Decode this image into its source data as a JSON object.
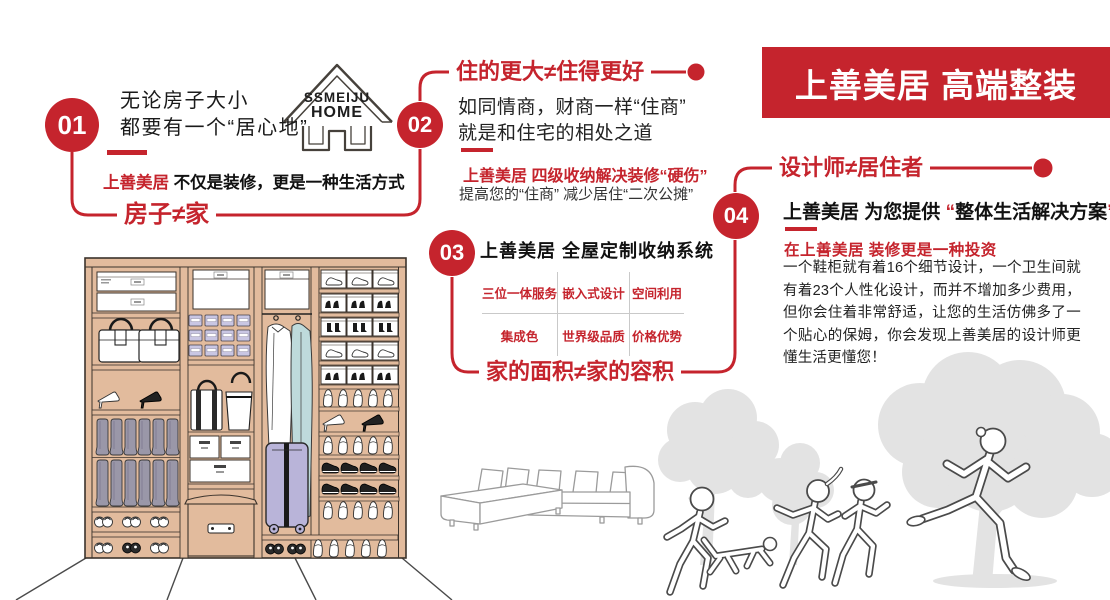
{
  "banner": {
    "title": "上善美居 高端整装"
  },
  "logo": {
    "line1": "SSMEIJU",
    "line2": "HOME"
  },
  "sections": {
    "s1": {
      "num": "01",
      "heading_line1": "无论房子大小",
      "heading_line2": "都要有一个“居心地”",
      "brand": "上善美居",
      "slogan": "不仅是装修，更是一种生活方式",
      "keyword": "房子≠家"
    },
    "s2": {
      "num": "02",
      "headline": "住的更大≠住得更好",
      "body_line1": "如同情商，财商一样“住商”",
      "body_line2": "就是和住宅的相处之道",
      "red_line": "上善美居 四级收纳解决装修“硬伤”",
      "sub_line": "提高您的“住商” 减少居住“二次公摊”"
    },
    "s3": {
      "num": "03",
      "title": "上善美居 全屋定制收纳系统",
      "cells": [
        "三位一体服务",
        "嵌入式设计",
        "空间利用",
        "集成色",
        "世界级品质",
        "价格优势"
      ],
      "keyword": "家的面积≠家的容积"
    },
    "s4": {
      "num": "04",
      "headline": "设计师≠居住者",
      "bold_prefix": "上善美居 为您提供 ",
      "quote_open": "“",
      "quote_text": "整体生活解决方案",
      "quote_close": "”",
      "red_line": "在上善美居 装修更是一种投资",
      "paragraph": "一个鞋柜就有着16个细节设计，一个卫生间就有着23个人性化设计，而并不增加多少费用，但你会住着非常舒适，让您的生活仿佛多了一个贴心的保姆，你会发现上善美居的设计师更懂生活更懂您！"
    }
  },
  "colors": {
    "accent_red": "#c5242d",
    "wardrobe_tan": "#e2bb9d",
    "silhouette_gray": "#e3e3e3"
  }
}
